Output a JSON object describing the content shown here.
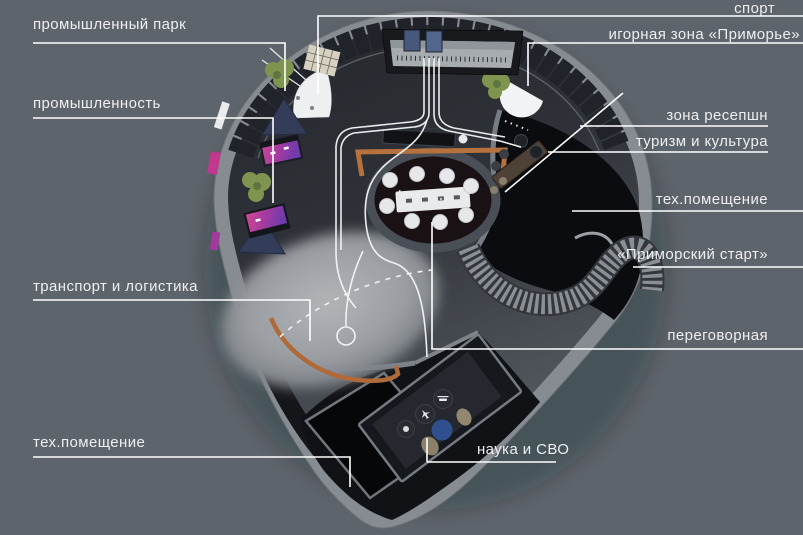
{
  "labels": {
    "industrial_park": "промышленный парк",
    "industry": "промышленность",
    "transport_logistics": "транспорт и логистика",
    "tech_room_left": "тех.помещение",
    "sport": "спорт",
    "gaming_zone": "игорная зона «Приморье»",
    "reception_zone": "зона ресепшн",
    "tourism_culture": "туризм и культура",
    "tech_room_right": "тех.помещение",
    "primorsky_start": "«Приморский старт»",
    "meeting_room": "переговорная",
    "science_svo": "наука и СВО"
  },
  "colors": {
    "background": "#5e646b",
    "label_text": "#edeff2",
    "leader_line": "#ffffff",
    "wall": "#878c92",
    "floor_dark": "#24272c",
    "floor_light": "#a8acb0",
    "copper_rail": "#b5703f",
    "navy_exhibit": "#333d59",
    "magenta_display": "#c23b8e",
    "purple_display": "#7b3fae",
    "plant_green": "#7f944e",
    "science_pod_blue": "#2f4f8e"
  },
  "icons": {
    "science_pods": [
      "airplane",
      "helicopter",
      "globe"
    ]
  }
}
